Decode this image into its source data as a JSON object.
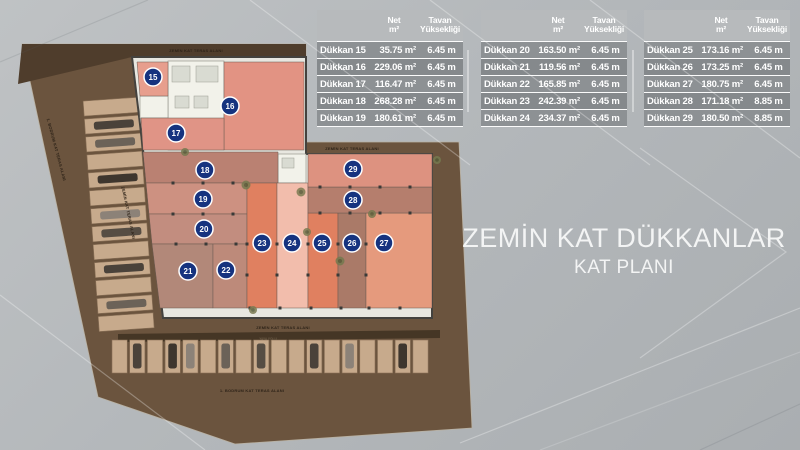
{
  "title": {
    "line1": "ZEMİN KAT DÜKKANLAR",
    "line2": "KAT PLANI"
  },
  "table_headers": {
    "net_line1": "Net",
    "net_line2": "m²",
    "tavan_line1": "Tavan",
    "tavan_line2": "Yüksekliği"
  },
  "tables": [
    {
      "rows": [
        {
          "name": "Dükkan 15",
          "net": "35.75 m²",
          "height": "6.45 m"
        },
        {
          "name": "Dükkan 16",
          "net": "229.06 m²",
          "height": "6.45 m"
        },
        {
          "name": "Dükkan 17",
          "net": "116.47 m²",
          "height": "6.45 m"
        },
        {
          "name": "Dükkan 18",
          "net": "268.28 m²",
          "height": "6.45 m"
        },
        {
          "name": "Dükkan 19",
          "net": "180.61 m²",
          "height": "6.45 m"
        }
      ]
    },
    {
      "rows": [
        {
          "name": "Dükkan 20",
          "net": "163.50 m²",
          "height": "6.45 m"
        },
        {
          "name": "Dükkan 21",
          "net": "119.56 m²",
          "height": "6.45 m"
        },
        {
          "name": "Dükkan 22",
          "net": "165.85 m²",
          "height": "6.45 m"
        },
        {
          "name": "Dükkan 23",
          "net": "242.39 m²",
          "height": "6.45 m"
        },
        {
          "name": "Dükkan 24",
          "net": "234.37 m²",
          "height": "6.45 m"
        }
      ]
    },
    {
      "rows": [
        {
          "name": "Dükkan 25",
          "net": "173.16 m²",
          "height": "6.45 m"
        },
        {
          "name": "Dükkan 26",
          "net": "173.25 m²",
          "height": "6.45 m"
        },
        {
          "name": "Dükkan 27",
          "net": "180.75 m²",
          "height": "6.45 m"
        },
        {
          "name": "Dükkan 28",
          "net": "171.18 m²",
          "height": "8.85 m"
        },
        {
          "name": "Dükkan 29",
          "net": "180.50 m²",
          "height": "8.85 m"
        }
      ]
    }
  ],
  "plan": {
    "badge_color": "#16337f",
    "units": [
      {
        "no": "15",
        "color": "#e79e8d"
      },
      {
        "no": "16",
        "color": "#e29383"
      },
      {
        "no": "17",
        "color": "#e09486"
      },
      {
        "no": "18",
        "color": "#ba8172"
      },
      {
        "no": "19",
        "color": "#cd9181"
      },
      {
        "no": "20",
        "color": "#c28d7f"
      },
      {
        "no": "21",
        "color": "#b28879"
      },
      {
        "no": "22",
        "color": "#bd8a7a"
      },
      {
        "no": "23",
        "color": "#e08060"
      },
      {
        "no": "24",
        "color": "#f2bdac"
      },
      {
        "no": "25",
        "color": "#e08060"
      },
      {
        "no": "26",
        "color": "#aa7a68"
      },
      {
        "no": "27",
        "color": "#e59a7d"
      },
      {
        "no": "28",
        "color": "#b57e6d"
      },
      {
        "no": "29",
        "color": "#dd9280"
      }
    ],
    "labels": {
      "terrace_top": "ZEMİN KAT TERAS ALANI",
      "terrace_right": "ZEMİN KAT TERAS ALANI",
      "terrace_bottom": "ZEMİN KAT TERAS ALANI",
      "terrace_left_diagonal": "ZEMİN KAT TERAS ALANI",
      "basement_bottom": "1. BODRUM KAT TERAS ALANI",
      "basement_left_diagonal": "1. BODRUM KAT TERAS ALANI",
      "road": "YAYA YOLU"
    }
  },
  "colors": {
    "site_brown": "#6b543e",
    "site_dark": "#4f3d2c",
    "building_floor": "#e8e7e0",
    "stall_tan": "#c7aa8c",
    "title_text": "#f3f4f4"
  }
}
